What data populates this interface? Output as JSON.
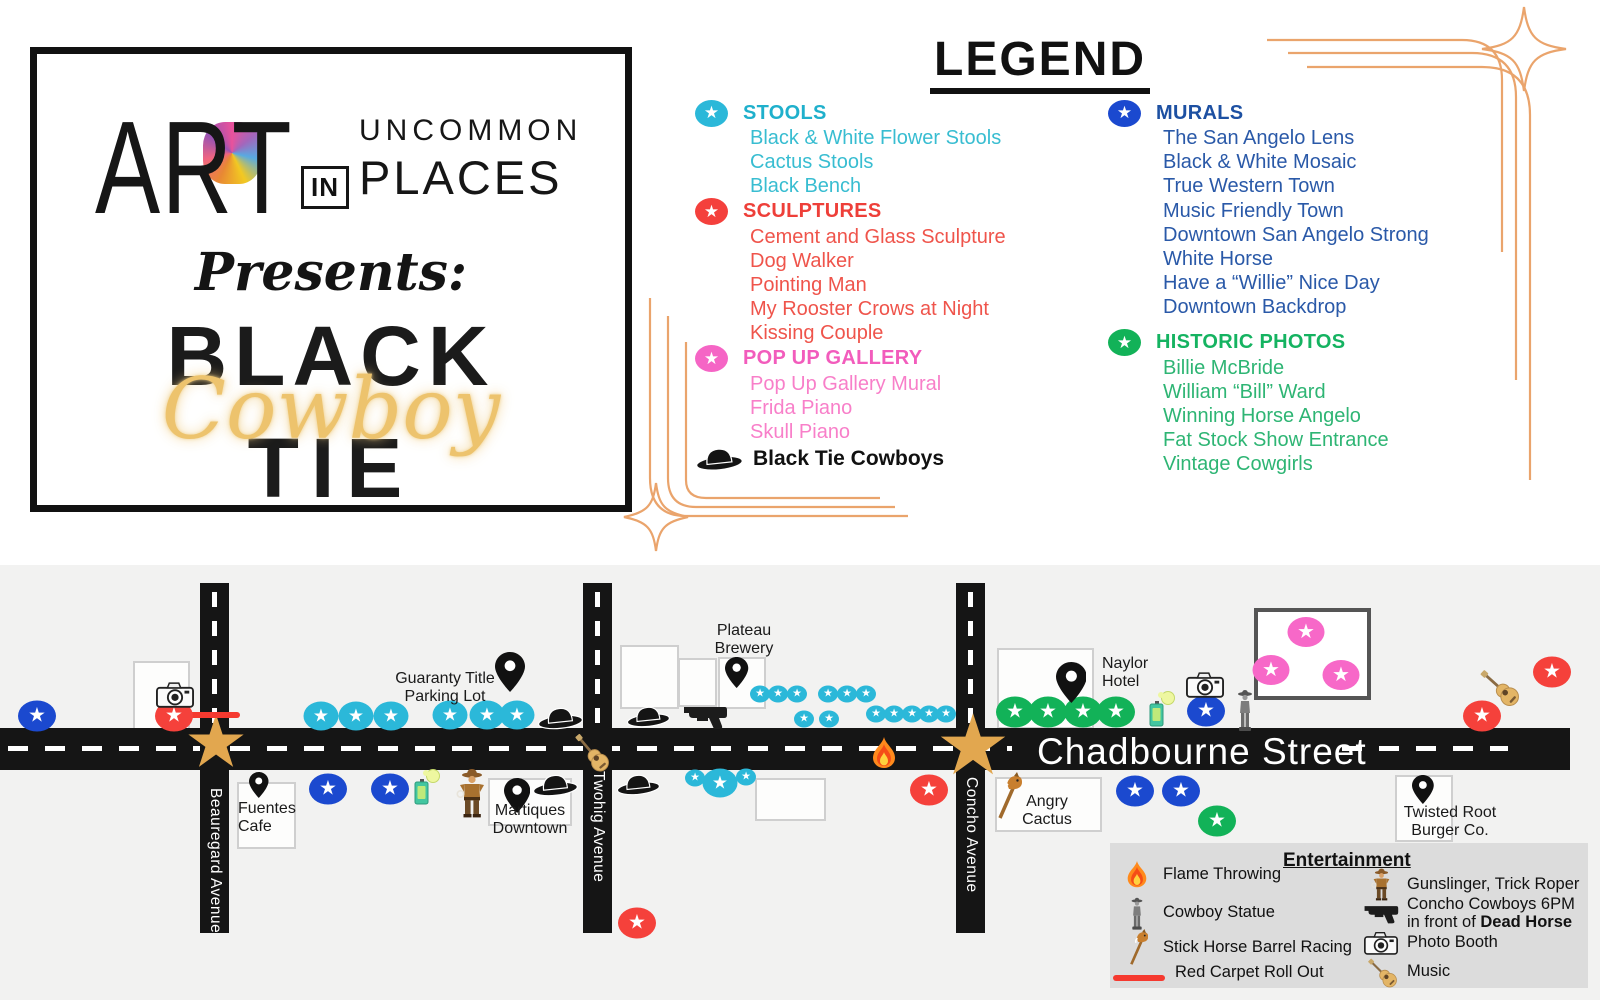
{
  "logo": {
    "art": "ART",
    "in": "IN",
    "uncommon": "UNCOMMON",
    "places": "PLACES",
    "presents": "Presents:",
    "black": "BLACK",
    "cowboy": "Cowboy",
    "tie": "TIE"
  },
  "legend": {
    "title": "LEGEND",
    "columns": {
      "left": [
        "stools",
        "sculptures",
        "popup"
      ],
      "right": [
        "murals",
        "historic"
      ]
    },
    "sections": {
      "stools": {
        "id": "stools",
        "label": "STOOLS",
        "marker": "#2bb8d9",
        "header_color": "#1fb0cc",
        "item_color": "#38bdd1",
        "items": [
          "Black & White Flower Stools",
          "Cactus Stools",
          "Black Bench"
        ]
      },
      "sculptures": {
        "id": "sculptures",
        "label": "SCULPTURES",
        "marker": "#f4403c",
        "header_color": "#ee3f39",
        "item_color": "#ef544b",
        "items": [
          "Cement and Glass Sculpture",
          "Dog Walker",
          "Pointing Man",
          "My Rooster Crows at Night",
          "Kissing Couple"
        ]
      },
      "popup": {
        "id": "pop-up-gallery",
        "label": "POP UP GALLERY",
        "marker": "#f565c5",
        "header_color": "#f25cbc",
        "item_color": "#f87fc9",
        "items": [
          "Pop Up Gallery Mural",
          "Frida Piano",
          "Skull Piano"
        ]
      },
      "murals": {
        "id": "murals",
        "label": "MURALS",
        "marker": "#1b49cf",
        "header_color": "#1d50a2",
        "item_color": "#2a59a8",
        "items": [
          "The San Angelo Lens",
          "Black & White Mosaic",
          "True Western Town",
          "Music Friendly Town",
          "Downtown San Angelo Strong",
          "White Horse",
          "Have a “Willie” Nice Day",
          "Downtown Backdrop"
        ]
      },
      "historic": {
        "id": "historic-photos",
        "label": "HISTORIC PHOTOS",
        "marker": "#12b258",
        "header_color": "#15b361",
        "item_color": "#2eb574",
        "items": [
          "Billie McBride",
          "William “Bill” Ward",
          "Winning Horse Angelo",
          "Fat Stock Show Entrance",
          "Vintage Cowgirls"
        ]
      }
    },
    "special": {
      "label": "Black Tie Cowboys"
    }
  },
  "map": {
    "bg": "#f2f2f1",
    "road_color": "#151515",
    "gold": "#e2a74f",
    "horizontal_road": {
      "label": "Chadbourne Street",
      "x": 0,
      "y": 163,
      "w": 1570,
      "h": 42,
      "label_x": 1037,
      "label_y": 166,
      "dashes": [
        [
          8,
          1012
        ],
        [
          1342,
          1508
        ]
      ],
      "dash_y": 181
    },
    "vertical_roads": [
      {
        "label": "Beauregard Avenue",
        "x": 200,
        "y": 18,
        "w": 29,
        "h": 350,
        "label_y": 223
      },
      {
        "label": "Twohig Avenue",
        "x": 583,
        "y": 18,
        "w": 29,
        "h": 350,
        "label_y": 206
      },
      {
        "label": "Concho Avenue",
        "x": 956,
        "y": 18,
        "w": 29,
        "h": 350,
        "label_y": 212
      }
    ],
    "buildings": [
      [
        133,
        96,
        53,
        65
      ],
      [
        237,
        217,
        55,
        63
      ],
      [
        488,
        213,
        80,
        44
      ],
      [
        620,
        80,
        55,
        60
      ],
      [
        678,
        93,
        35,
        45
      ],
      [
        718,
        92,
        44,
        48
      ],
      [
        755,
        213,
        67,
        39
      ],
      [
        997,
        83,
        93,
        77
      ],
      [
        995,
        212,
        103,
        51
      ],
      [
        1395,
        210,
        54,
        63
      ]
    ],
    "popup_frame": [
      1254,
      43,
      109,
      84
    ],
    "gold_stars": [
      {
        "x": 216,
        "y": 182,
        "s": 72
      },
      {
        "x": 973,
        "y": 185,
        "s": 84
      }
    ],
    "red_carpet": {
      "x": 188,
      "y": 147,
      "w": 52,
      "h": 6
    },
    "marker_types": {
      "stool-marker": {
        "color": "#2bb8d9",
        "w": 35,
        "h": 29,
        "fs": 18
      },
      "stool-marker-small": {
        "color": "#2bb8d9",
        "w": 20,
        "h": 17,
        "fs": 11
      },
      "mural-marker": {
        "color": "#1b49cf",
        "w": 38,
        "h": 31,
        "fs": 20
      },
      "historic-marker": {
        "color": "#12b258",
        "w": 38,
        "h": 31,
        "fs": 20
      },
      "sculpture-marker": {
        "color": "#f5413b",
        "w": 38,
        "h": 31,
        "fs": 20
      },
      "popup-marker": {
        "color": "#f768c8",
        "w": 37,
        "h": 30,
        "fs": 20
      }
    },
    "marker_points": {
      "stool-marker": [
        [
          321,
          151
        ],
        [
          356,
          151
        ],
        [
          391,
          151
        ],
        [
          450,
          150
        ],
        [
          487,
          150
        ],
        [
          517,
          150
        ],
        [
          720,
          218
        ]
      ],
      "stool-marker-small": [
        [
          760,
          129
        ],
        [
          778,
          129
        ],
        [
          797,
          129
        ],
        [
          828,
          129
        ],
        [
          847,
          129
        ],
        [
          866,
          129
        ],
        [
          804,
          154
        ],
        [
          829,
          154
        ],
        [
          876,
          149
        ],
        [
          894,
          149
        ],
        [
          912,
          149
        ],
        [
          929,
          149
        ],
        [
          946,
          149
        ],
        [
          695,
          213
        ],
        [
          746,
          212
        ]
      ],
      "mural-marker": [
        [
          37,
          151
        ],
        [
          328,
          224
        ],
        [
          390,
          224
        ],
        [
          1206,
          146
        ],
        [
          1135,
          226
        ],
        [
          1181,
          226
        ]
      ],
      "historic-marker": [
        [
          1015,
          147
        ],
        [
          1048,
          147
        ],
        [
          1083,
          147
        ],
        [
          1116,
          147
        ],
        [
          1217,
          256
        ]
      ],
      "sculpture-marker": [
        [
          174,
          151
        ],
        [
          637,
          358
        ],
        [
          929,
          225
        ],
        [
          1482,
          151
        ],
        [
          1552,
          107
        ]
      ],
      "popup-marker": [
        [
          1306,
          67
        ],
        [
          1271,
          105
        ],
        [
          1341,
          110
        ]
      ]
    },
    "pins": [
      {
        "x": 510,
        "y": 87,
        "h": 40
      },
      {
        "x": 259,
        "y": 207,
        "h": 26
      },
      {
        "x": 517,
        "y": 213,
        "h": 35
      },
      {
        "x": 737,
        "y": 92,
        "h": 31
      },
      {
        "x": 1071,
        "y": 97,
        "h": 41
      },
      {
        "x": 1423,
        "y": 210,
        "h": 29
      }
    ],
    "labels": [
      {
        "lines": [
          "Guaranty Title",
          "Parking Lot"
        ],
        "x": 445,
        "y": 105,
        "align": "center"
      },
      {
        "lines": [
          "Fuentes",
          "Cafe"
        ],
        "x": 238,
        "y": 235,
        "align": "left"
      },
      {
        "lines": [
          "Martiques",
          "Downtown"
        ],
        "x": 530,
        "y": 237,
        "align": "center"
      },
      {
        "lines": [
          "Plateau",
          "Brewery"
        ],
        "x": 744,
        "y": 57,
        "align": "center"
      },
      {
        "lines": [
          "Naylor",
          "Hotel"
        ],
        "x": 1102,
        "y": 90,
        "align": "left"
      },
      {
        "lines": [
          "Angry",
          "Cactus"
        ],
        "x": 1047,
        "y": 228,
        "align": "center"
      },
      {
        "lines": [
          "Twisted Root",
          "Burger Co."
        ],
        "x": 1450,
        "y": 239,
        "align": "center"
      }
    ],
    "icons": [
      {
        "name": "camera-icon",
        "x": 175,
        "y": 129,
        "w": 38,
        "h": 27
      },
      {
        "name": "camera-icon",
        "x": 1205,
        "y": 119,
        "w": 38,
        "h": 27
      },
      {
        "name": "cowboy-hat-icon",
        "x": 560,
        "y": 152,
        "w": 46,
        "h": 25
      },
      {
        "name": "cowboy-hat-icon",
        "x": 648,
        "y": 151,
        "w": 44,
        "h": 24
      },
      {
        "name": "cowboy-hat-icon",
        "x": 555,
        "y": 219,
        "w": 46,
        "h": 25
      },
      {
        "name": "cowboy-hat-icon",
        "x": 638,
        "y": 219,
        "w": 44,
        "h": 24
      },
      {
        "name": "revolver-icon",
        "x": 705,
        "y": 151,
        "w": 46,
        "h": 27
      },
      {
        "name": "guitar-icon",
        "x": 592,
        "y": 188,
        "w": 22,
        "h": 46,
        "rot": -40
      },
      {
        "name": "guitar-icon",
        "x": 1500,
        "y": 123,
        "w": 22,
        "h": 48,
        "rot": -48
      },
      {
        "name": "flame-icon",
        "x": 884,
        "y": 188,
        "w": 26,
        "h": 32
      },
      {
        "name": "spray-can-icon",
        "x": 426,
        "y": 222,
        "w": 28,
        "h": 36
      },
      {
        "name": "spray-can-icon",
        "x": 1161,
        "y": 144,
        "w": 28,
        "h": 36
      },
      {
        "name": "gunslinger-icon",
        "x": 472,
        "y": 228,
        "w": 32,
        "h": 50
      },
      {
        "name": "cowboy-statue-icon",
        "x": 1245,
        "y": 146,
        "w": 18,
        "h": 44
      },
      {
        "name": "stick-horse-icon",
        "x": 1008,
        "y": 231,
        "w": 30,
        "h": 48
      }
    ]
  },
  "entertainment": {
    "panel": {
      "x": 1110,
      "y": 278,
      "w": 478,
      "h": 145
    },
    "title": "Entertainment",
    "title_x": 1283,
    "title_y": 285,
    "rows": [
      {
        "col": "left",
        "x": 1118,
        "y": 296,
        "icon": "flame-icon",
        "iw": 22,
        "ih": 28,
        "slot": 38,
        "label": "Flame Throwing"
      },
      {
        "col": "left",
        "x": 1118,
        "y": 332,
        "icon": "cowboy-statue-icon",
        "iw": 14,
        "ih": 32,
        "slot": 38,
        "label": "Cowboy Statue"
      },
      {
        "col": "left",
        "x": 1118,
        "y": 364,
        "icon": "stick-horse-icon",
        "iw": 23,
        "ih": 37,
        "slot": 38,
        "label": "Stick Horse Barrel Racing"
      },
      {
        "col": "left",
        "x": 1110,
        "y": 398,
        "icon": "red-carpet-icon",
        "iw": 52,
        "ih": 8,
        "slot": 58,
        "label": "Red Carpet Roll Out"
      },
      {
        "col": "right",
        "x": 1362,
        "y": 303,
        "icon": "gunslinger-icon",
        "iw": 21,
        "ih": 33,
        "slot": 38,
        "label": "Gunslinger, Trick Roper"
      },
      {
        "col": "right",
        "x": 1362,
        "y": 331,
        "icon": "revolver-icon",
        "iw": 36,
        "ih": 21,
        "slot": 38,
        "label": "Concho Cowboys 6PM",
        "label2": "in front of ",
        "label2_bold": "Dead Horse"
      },
      {
        "col": "right",
        "x": 1362,
        "y": 366,
        "icon": "camera-icon",
        "iw": 34,
        "ih": 24,
        "slot": 38,
        "label": "Photo Booth"
      },
      {
        "col": "right",
        "x": 1362,
        "y": 390,
        "icon": "guitar-icon",
        "iw": 17,
        "ih": 34,
        "slot": 38,
        "rot": -45,
        "label": "Music"
      }
    ]
  }
}
